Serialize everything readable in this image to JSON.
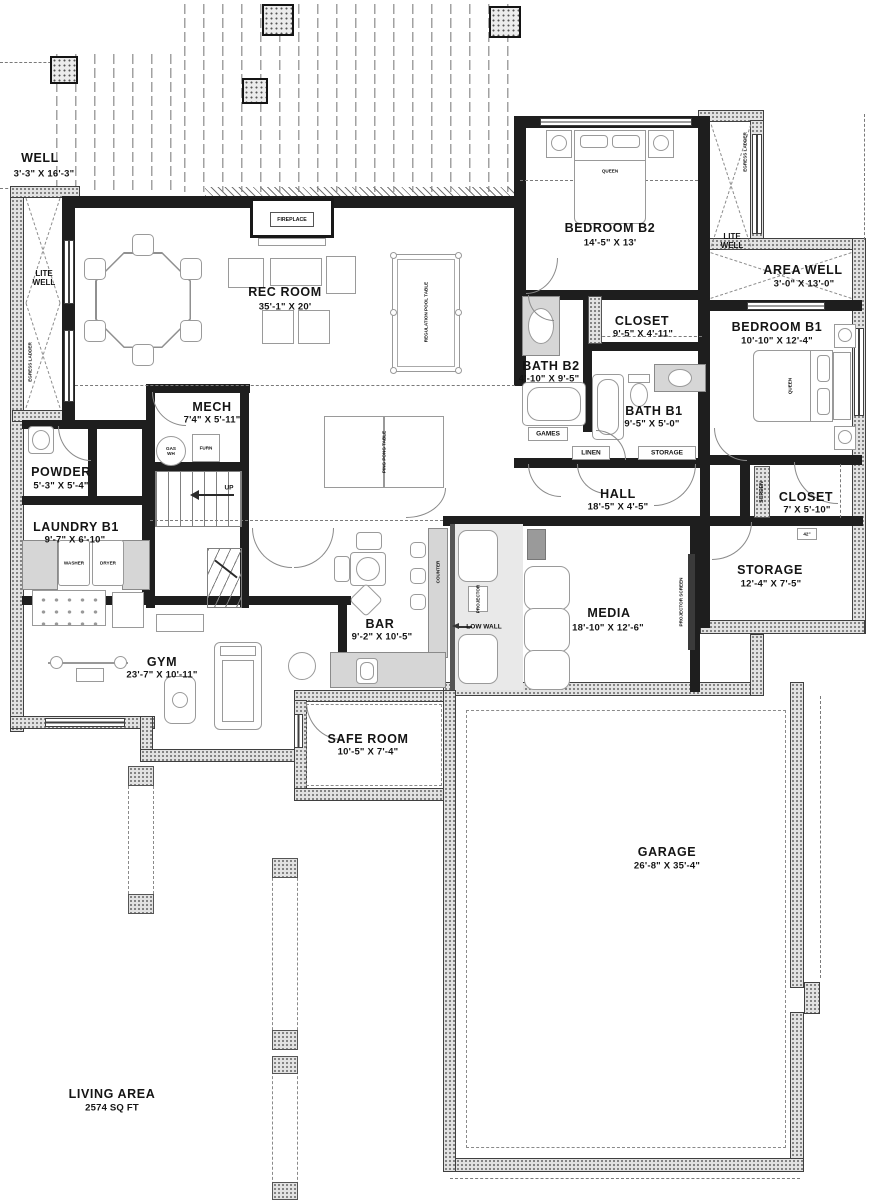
{
  "rooms": {
    "well": {
      "name": "WELL",
      "dims": "3'-3\" X 16'-3\""
    },
    "rec_room": {
      "name": "REC ROOM",
      "dims": "35'-1\" X 20'"
    },
    "bedroom_b2": {
      "name": "BEDROOM B2",
      "dims": "14'-5\" X 13'"
    },
    "area_well": {
      "name": "AREA WELL",
      "dims": "3'-0\" X 13'-0\""
    },
    "bedroom_b1": {
      "name": "BEDROOM B1",
      "dims": "10'-10\" X 12'-4\""
    },
    "closet_b2": {
      "name": "CLOSET",
      "dims": "9'-5\" X 4'-11\""
    },
    "bath_b2": {
      "name": "BATH B2",
      "dims": "4'-10\" X 9'-5\""
    },
    "bath_b1": {
      "name": "BATH B1",
      "dims": "9'-5\" X 5'-0\""
    },
    "hall": {
      "name": "HALL",
      "dims": "18'-5\" X 4'-5\""
    },
    "closet_b1": {
      "name": "CLOSET",
      "dims": "7' X 5'-10\""
    },
    "storage": {
      "name": "STORAGE",
      "dims": "12'-4\" X 7'-5\""
    },
    "mech": {
      "name": "MECH",
      "dims": "7'4\" X 5'-11\""
    },
    "powder": {
      "name": "POWDER",
      "dims": "5'-3\" X 5'-4\""
    },
    "laundry_b1": {
      "name": "LAUNDRY B1",
      "dims": "9'-7\" X 6'-10\""
    },
    "gym": {
      "name": "GYM",
      "dims": "23'-7\" X 10'-11\""
    },
    "bar": {
      "name": "BAR",
      "dims": "9'-2\" X 10'-5\""
    },
    "media": {
      "name": "MEDIA",
      "dims": "18'-10\" X 12'-6\""
    },
    "safe_room": {
      "name": "SAFE ROOM",
      "dims": "10'-5\" X 7'-4\""
    },
    "garage": {
      "name": "GARAGE",
      "dims": "26'-8\" X 35'-4\""
    }
  },
  "living_area": {
    "label": "LIVING AREA",
    "value": "2574 SQ FT"
  },
  "annotations": {
    "fireplace": "FIREPLACE",
    "lite_well": "LITE WELL",
    "egress_ladder": "EGRESS LADDER",
    "queen": "QUEEN",
    "pool_table": "REGULATION POOL TABLE",
    "ping_pong_table": "PING PONG TABLE",
    "games": "GAMES",
    "linen": "LINEN",
    "storage_shelf": "STORAGE",
    "washer": "WASHER",
    "dryer": "DRYER",
    "counter": "COUNTER",
    "low_wall": "LOW WALL",
    "projector": "PROJECTOR",
    "projector_screen": "PROJECTOR SCREEN",
    "screen": "SCREEN",
    "up": "UP",
    "gas_wh": "GAS WH",
    "furnace": "FURN",
    "bench_42": "42\""
  }
}
